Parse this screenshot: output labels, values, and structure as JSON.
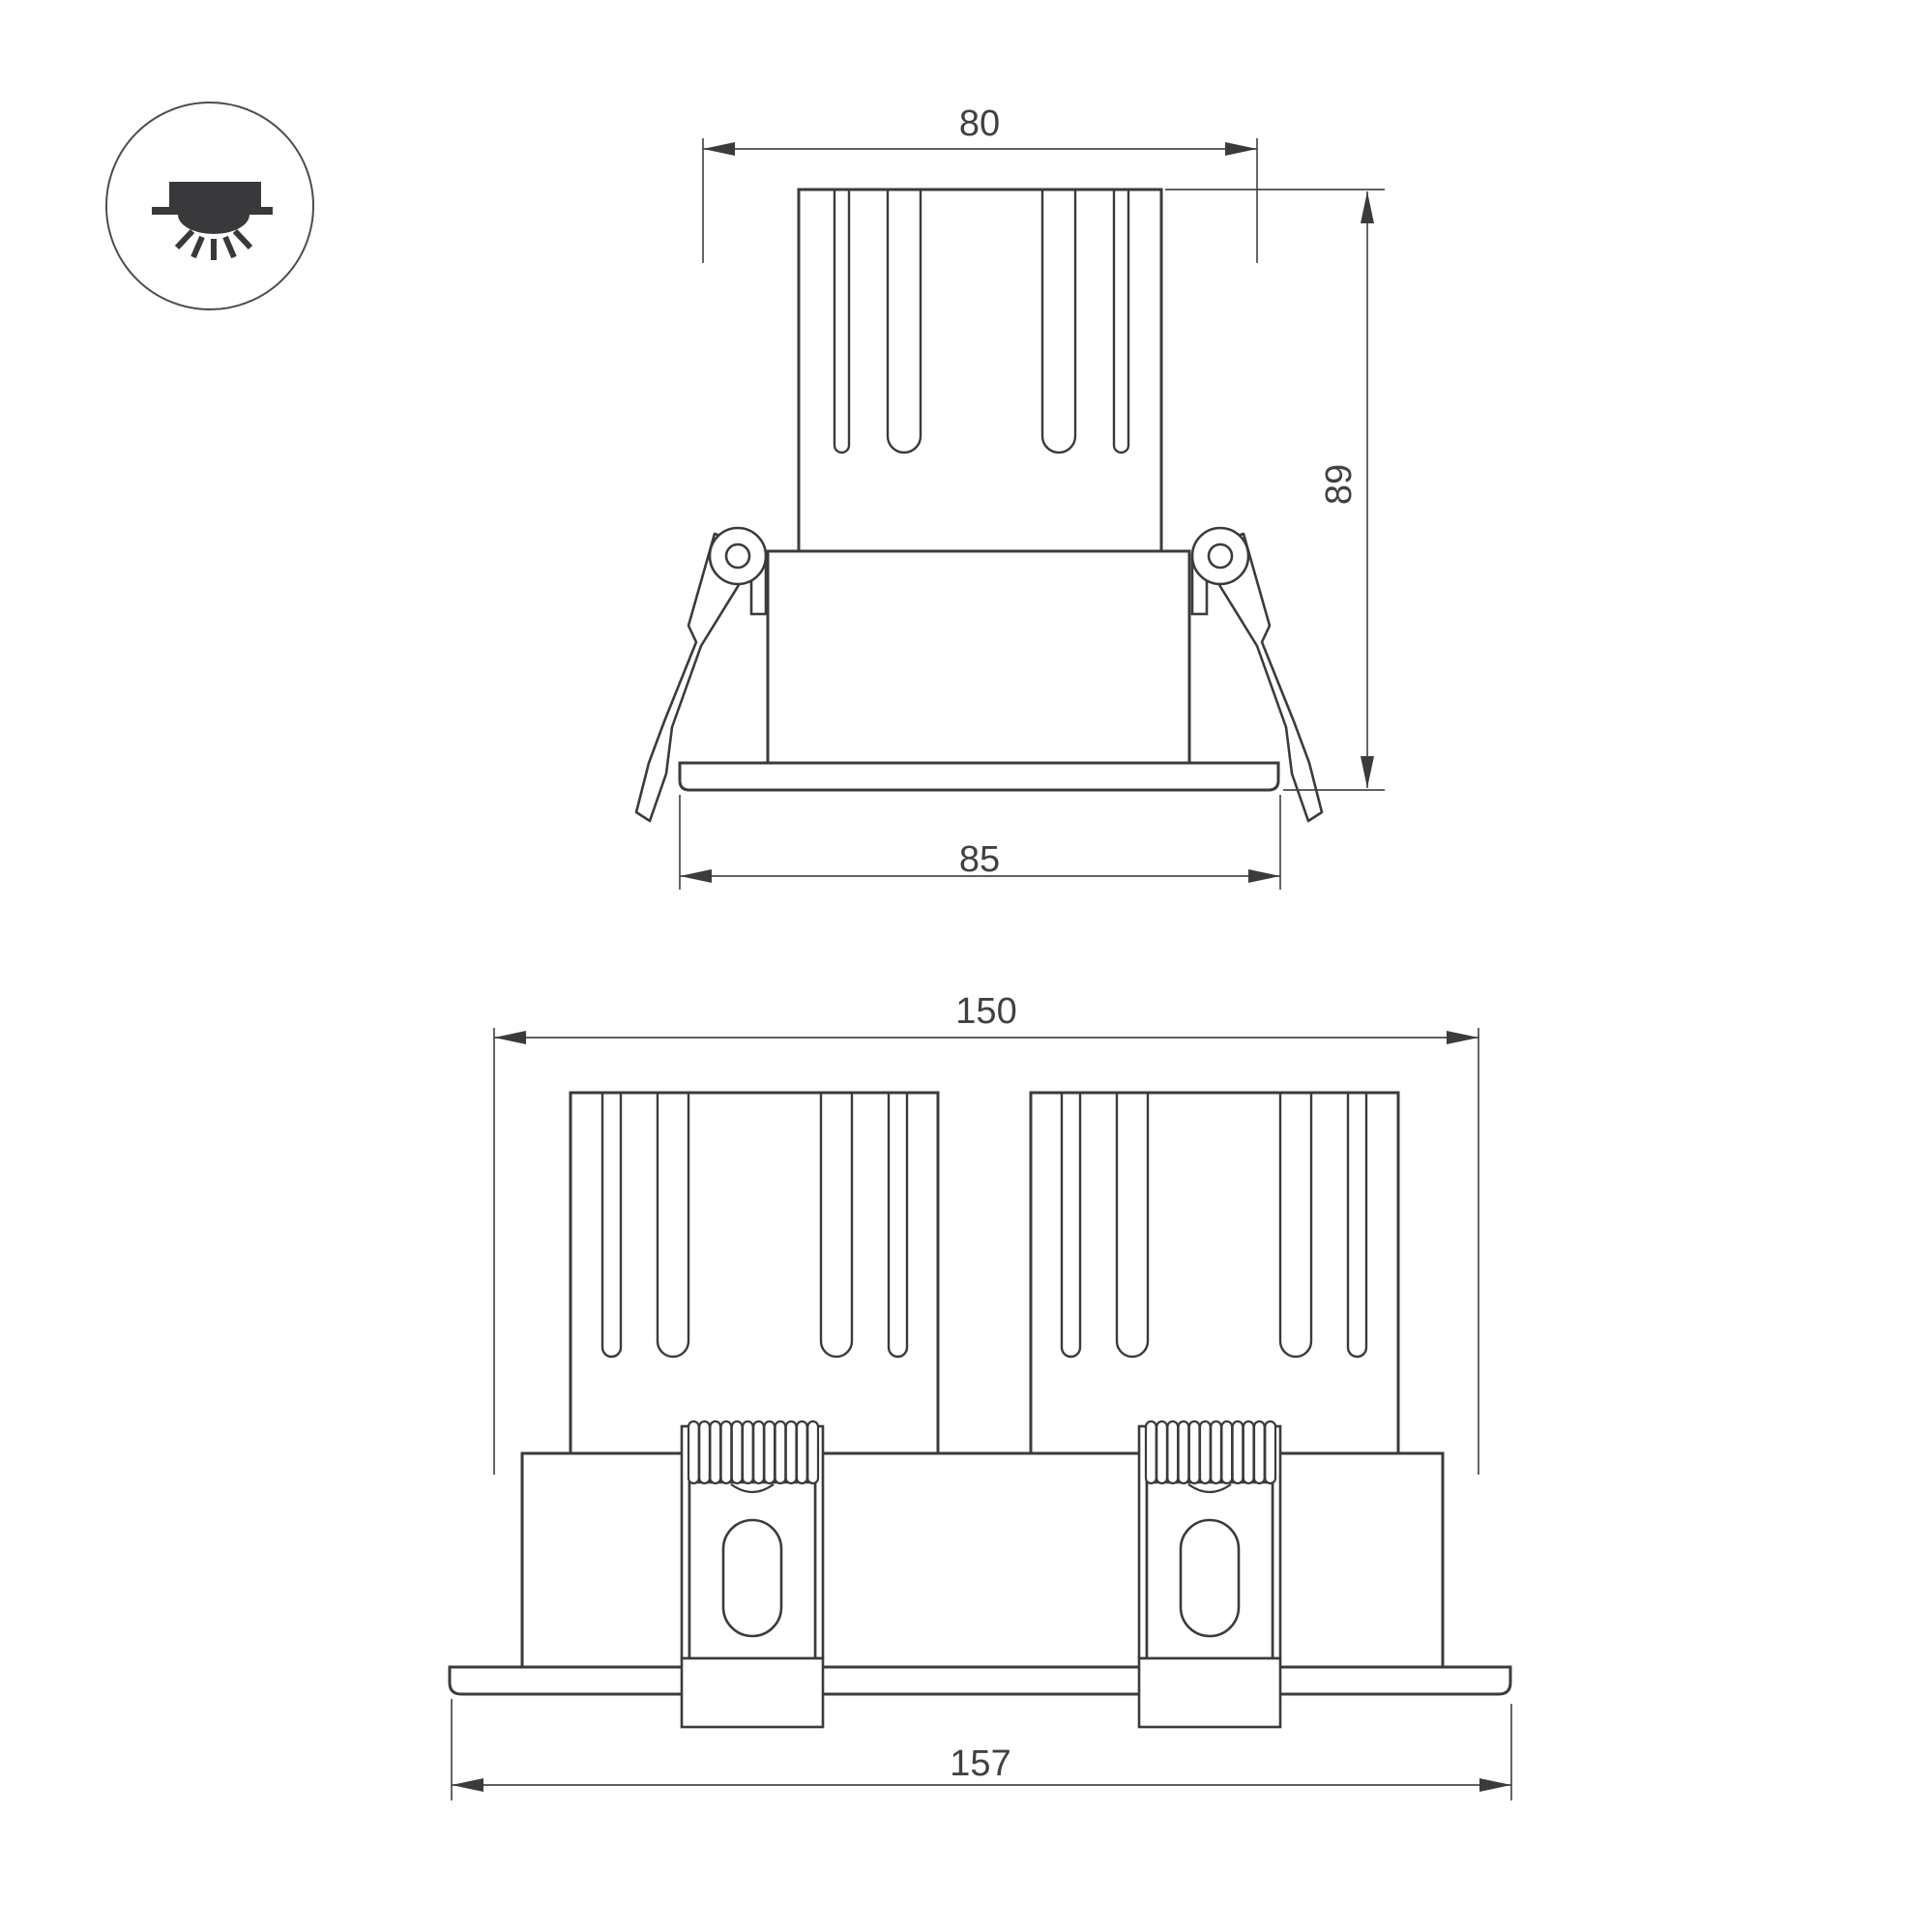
{
  "colors": {
    "background": "#ffffff",
    "part_line": "#3b3b3d",
    "dimension_line": "#4a4a4c",
    "label_text": "#414143",
    "icon_fill": "#39393b"
  },
  "icon": {
    "name": "recessed-downlight-symbol"
  },
  "views": {
    "front_single": {
      "dims": {
        "width_top": "80",
        "height": "89",
        "width_bottom": "85"
      }
    },
    "front_double": {
      "dims": {
        "width_top": "150",
        "width_bottom": "157"
      }
    }
  }
}
